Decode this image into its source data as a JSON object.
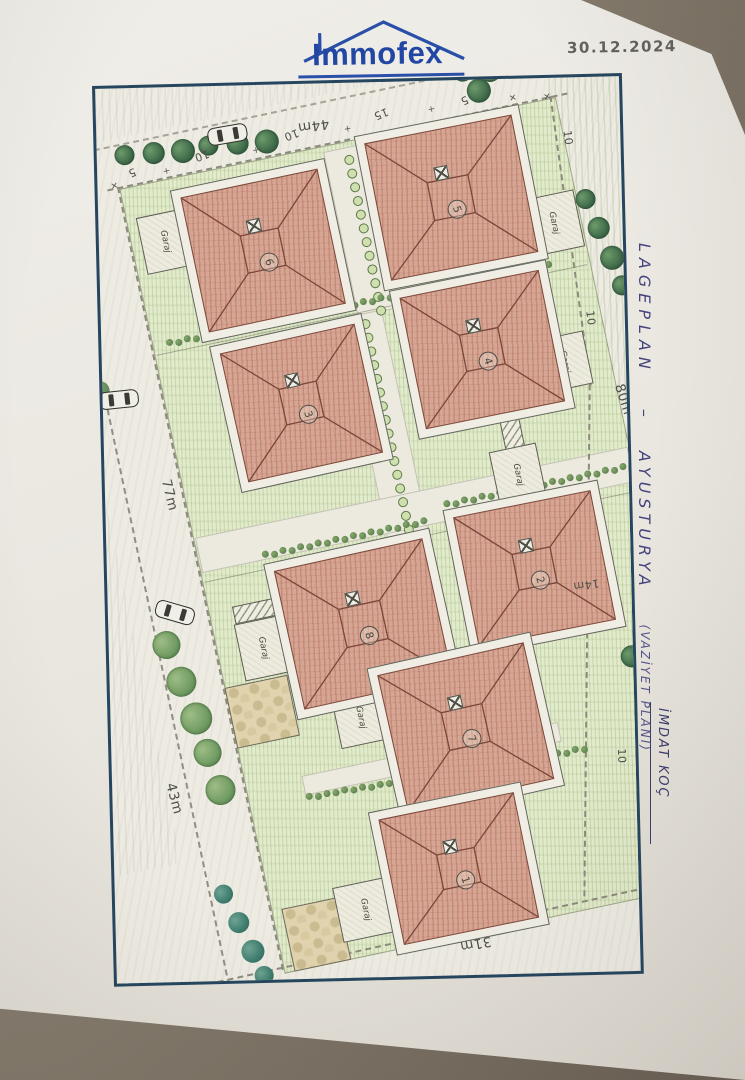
{
  "header": {
    "logo_text": "Immofex",
    "date": "30.12.2024"
  },
  "margin": {
    "title": "LAGEPLAN",
    "separator": "–",
    "subtitle": "AYUSTURYA",
    "paren": "(VAZİYET PLANI)",
    "author": "İMDAT KOÇ"
  },
  "plan": {
    "houses": [
      {
        "number": "6"
      },
      {
        "number": "5"
      },
      {
        "number": "3"
      },
      {
        "number": "4"
      },
      {
        "number": "8"
      },
      {
        "number": "2"
      },
      {
        "number": "7"
      },
      {
        "number": "1"
      }
    ],
    "garage_label": "Garaj",
    "dimensions": {
      "top": "44m",
      "left": "77m",
      "right": "80m",
      "mid_right": "14m",
      "bottom_left": "43m",
      "bottom": "31m"
    },
    "small_dims": [
      "5",
      "10",
      "10",
      "15",
      "5",
      "10",
      "10",
      "10",
      "15"
    ],
    "annotation": {
      "line1": "MEVCUT BİNA'",
      "line2": "Nakli sonra alınacak",
      "dim": "40m",
      "line3": "tek yapılacak"
    }
  },
  "colors": {
    "logo_blue": "#2a4fa8",
    "ink_blue": "#45447d",
    "roof_red": "#d6a694",
    "lawn_green": "#e3ebcd",
    "tree_green": "#3f6b4a",
    "frame_navy": "#26465f"
  }
}
